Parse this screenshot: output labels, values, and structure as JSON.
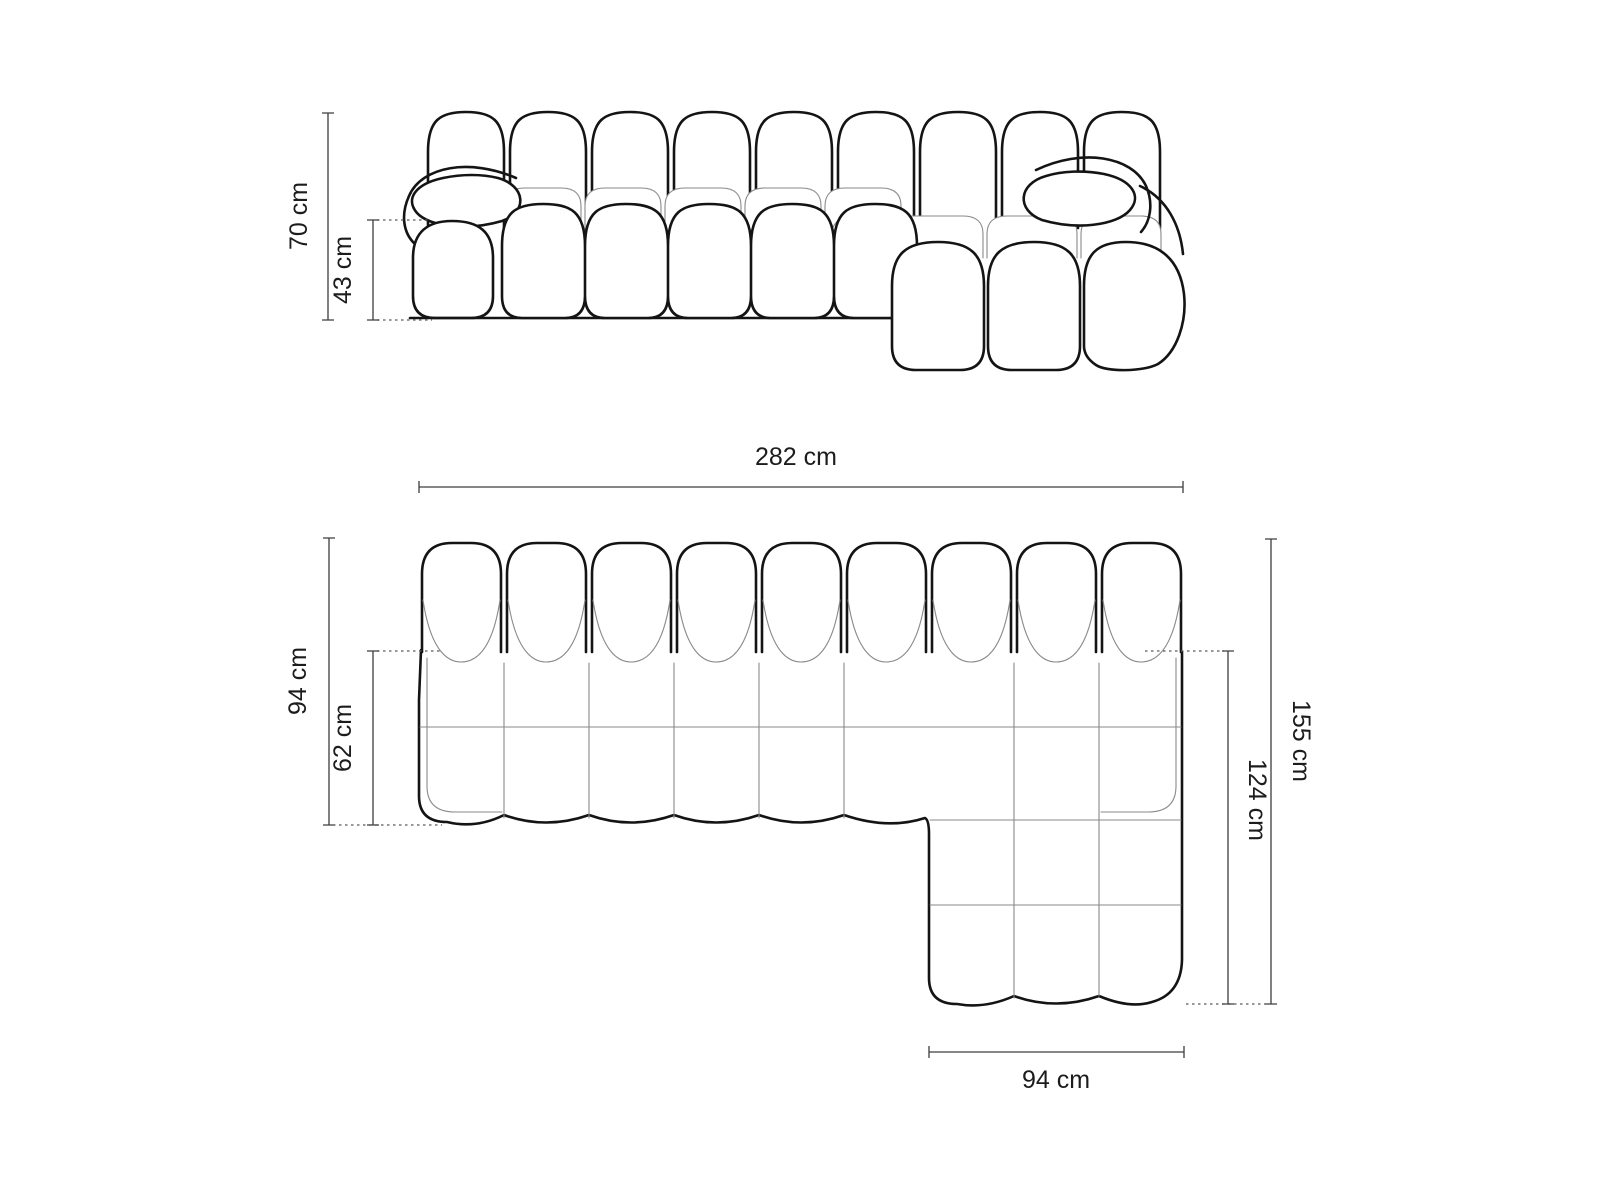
{
  "diagram": {
    "front_view": {
      "overall_height": "70 cm",
      "seat_height": "43 cm"
    },
    "top_view": {
      "overall_width": "282 cm",
      "body_depth": "94 cm",
      "seat_depth": "62 cm",
      "overall_depth": "155 cm",
      "chaise_depth": "124 cm",
      "chaise_width": "94 cm"
    },
    "colors": {
      "background": "#ffffff",
      "outline": "#141414",
      "thin_line": "#8a8a8a",
      "dimension_line": "#3d3d3d",
      "dashed_line": "#5a5a5a",
      "text": "#1c1c1c"
    }
  }
}
